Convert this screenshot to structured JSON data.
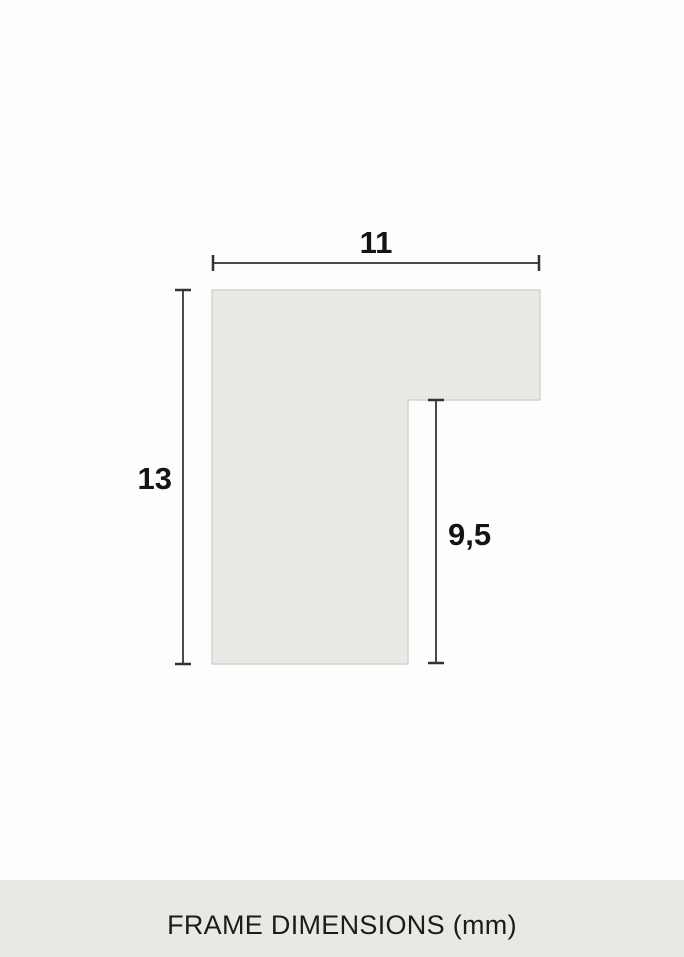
{
  "page": {
    "background": "#fdfdfd"
  },
  "diagram": {
    "name": "frame-profile-cross-section",
    "labels": {
      "width": "11",
      "height": "13",
      "depth": "9,5"
    },
    "colors": {
      "shape_fill": "#e9e9e5",
      "shape_stroke": "#d4d4ce",
      "dimension_line": "#4a4a4a",
      "dimension_cap": "#333333",
      "label_text": "#141414"
    }
  },
  "footer": {
    "label": "FRAME DIMENSIONS (mm)",
    "background": "#e8e8e4",
    "text_color": "#1c1c1c"
  }
}
